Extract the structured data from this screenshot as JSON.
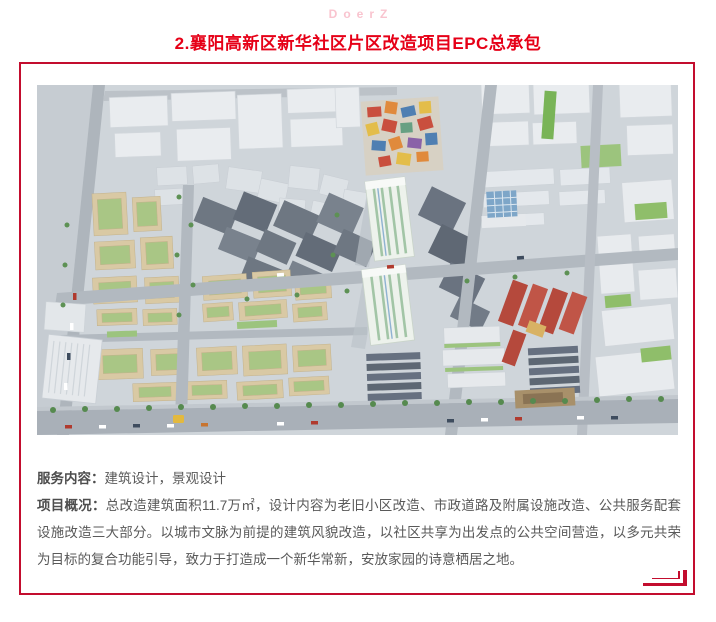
{
  "header": {
    "logo": "DoerZ",
    "title": "2.襄阳高新区新华社区片区改造项目EPC总承包"
  },
  "details": {
    "service": {
      "label": "服务内容：",
      "value": "建筑设计，景观设计"
    },
    "overview": {
      "label": "项目概况：",
      "value": "总改造建筑面积11.7万㎡，设计内容为老旧小区改造、市政道路及附属设施改造、公共服务配套设施改造三大部分。以城市文脉为前提的建筑风貌改造，以社区共享为出发点的公共空间营造，以多元共荣为目标的复合功能引导，致力于打造成一个新华常新，安放家园的诗意栖居之地。"
    }
  },
  "icons": {
    "bottom_right_mark": "double-corner-bracket"
  },
  "colors": {
    "accent_red": "#e60017",
    "frame_red": "#c30d2e",
    "logo_pink": "#f9c4cf",
    "text_gray": "#595959"
  }
}
